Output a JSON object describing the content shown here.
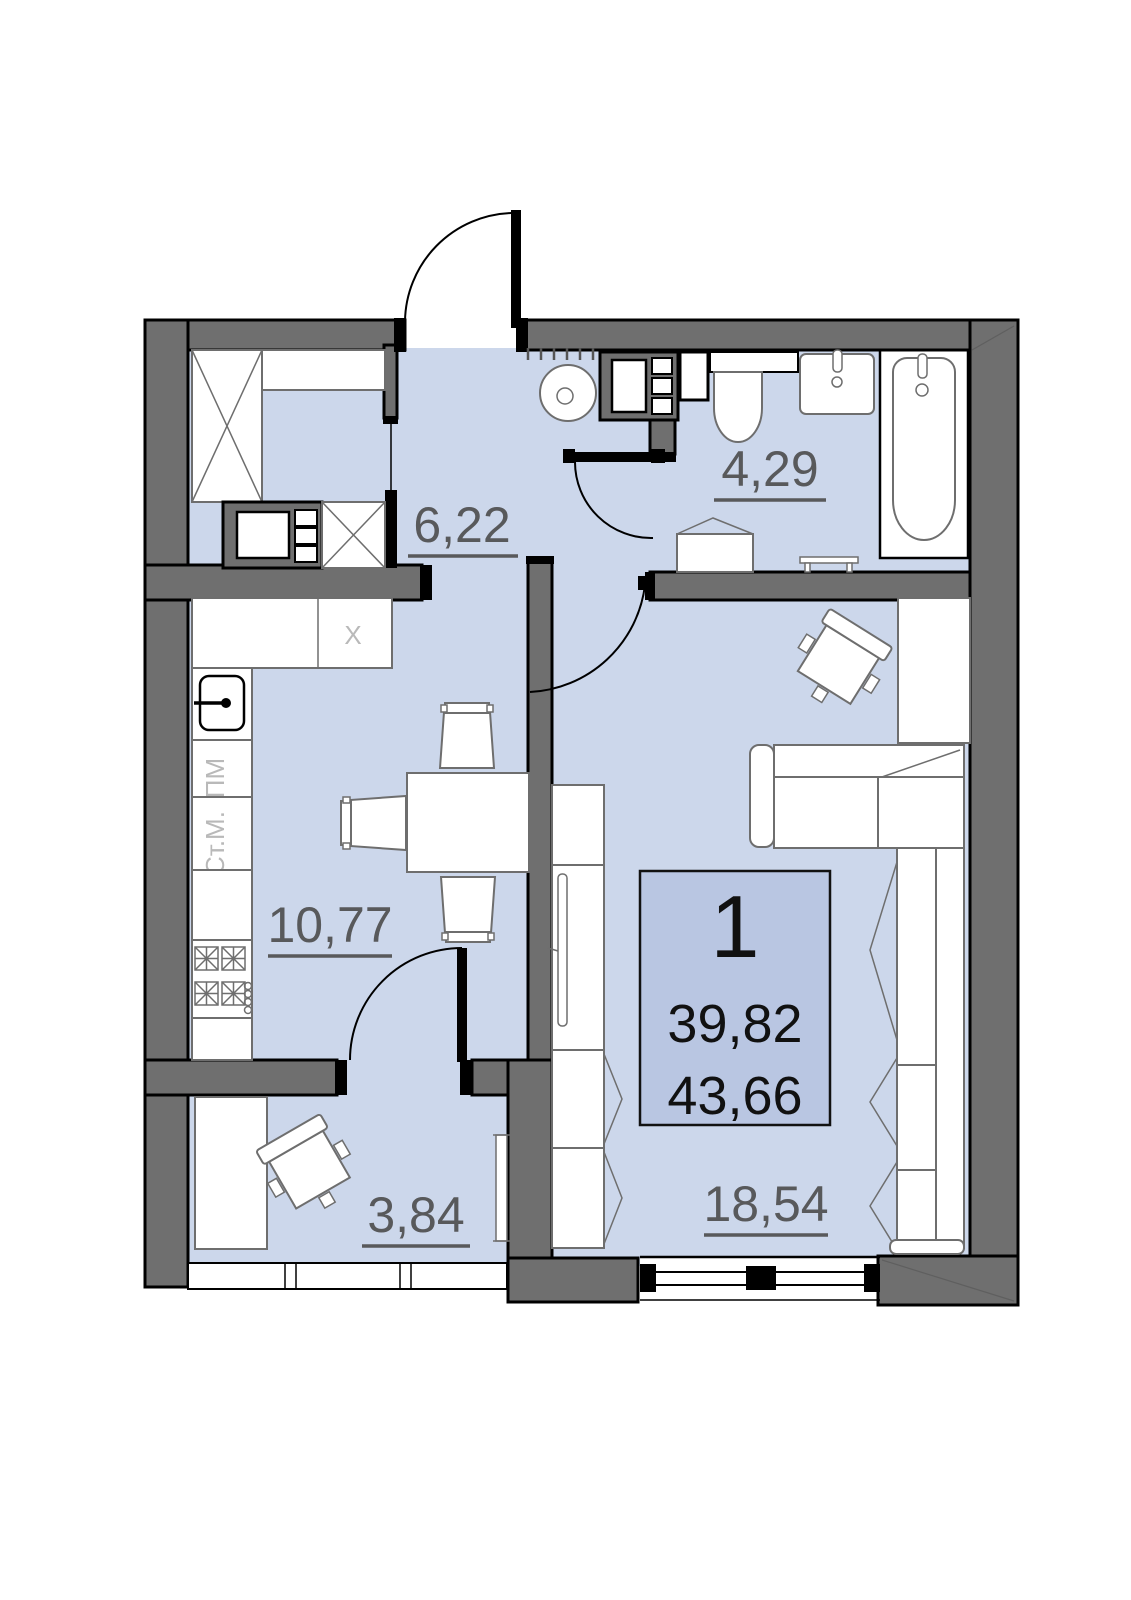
{
  "plan": {
    "info_box": {
      "unit_number": "1",
      "living_area": "39,82",
      "total_area": "43,66"
    },
    "rooms": {
      "hallway": {
        "area": "6,22"
      },
      "bathroom": {
        "area": "4,29"
      },
      "kitchen": {
        "area": "10,77"
      },
      "cabinet": {
        "area": "3,84"
      },
      "living_room": {
        "area": "18,54"
      }
    },
    "kitchen_labels": {
      "fridge": "X",
      "dishwasher": "ПМ",
      "washer": "Ст.М."
    },
    "colors": {
      "floor": "#ccd7eb",
      "infobox": "#b9c6e2",
      "wall": "#6f6f6f",
      "label": "#58595b",
      "furniture_stroke": "#6e6e6e"
    }
  }
}
